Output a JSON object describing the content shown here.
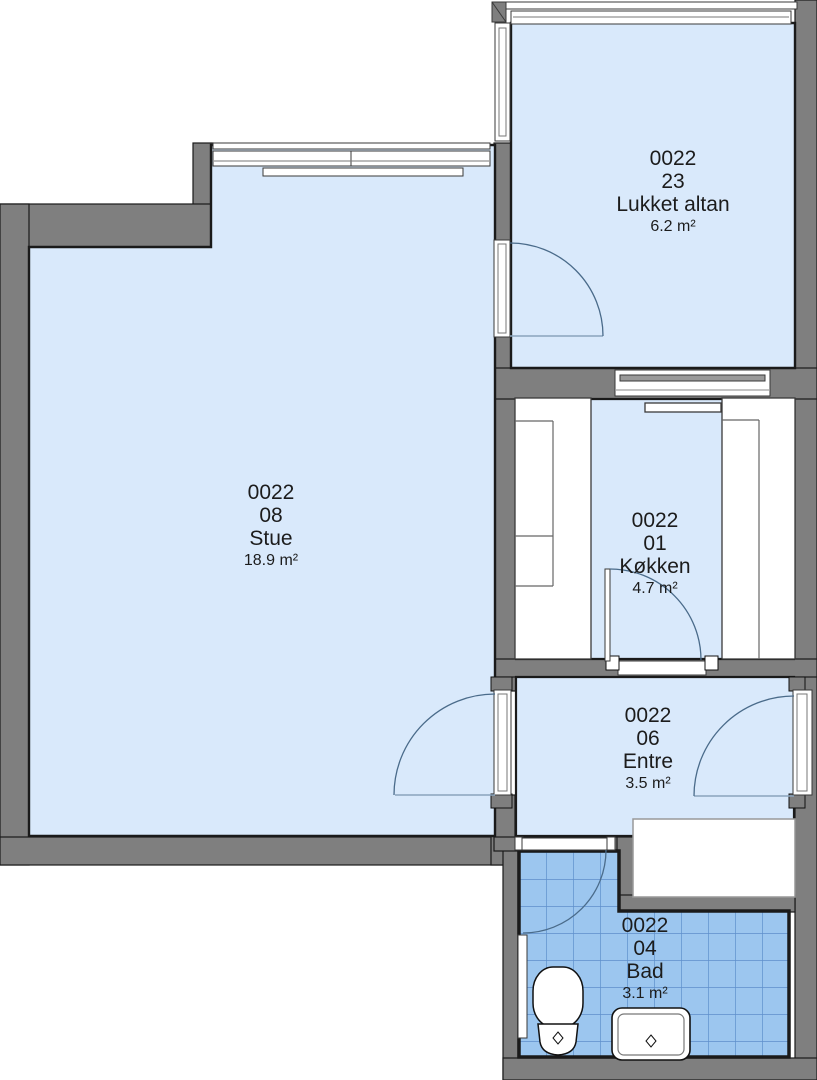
{
  "plan_type": "apartment floor plan",
  "rooms": [
    {
      "unit": "0022",
      "number": "23",
      "name": "Lukket altan",
      "area": "6.2 m²"
    },
    {
      "unit": "0022",
      "number": "08",
      "name": "Stue",
      "area": "18.9 m²"
    },
    {
      "unit": "0022",
      "number": "01",
      "name": "Køkken",
      "area": "4.7 m²"
    },
    {
      "unit": "0022",
      "number": "06",
      "name": "Entre",
      "area": "3.5 m²"
    },
    {
      "unit": "0022",
      "number": "04",
      "name": "Bad",
      "area": "3.1 m²"
    }
  ],
  "fixtures": [
    "toilet",
    "sink",
    "kitchen-counters",
    "wardrobe"
  ],
  "colors": {
    "room_fill": "#d9e9fb",
    "bath_tile": "#9cc6ef",
    "bath_grid": "#5e8fcb",
    "wall": "#7f7f7f",
    "outline": "#1a1a1a",
    "door_arc": "#4a6b8a"
  }
}
